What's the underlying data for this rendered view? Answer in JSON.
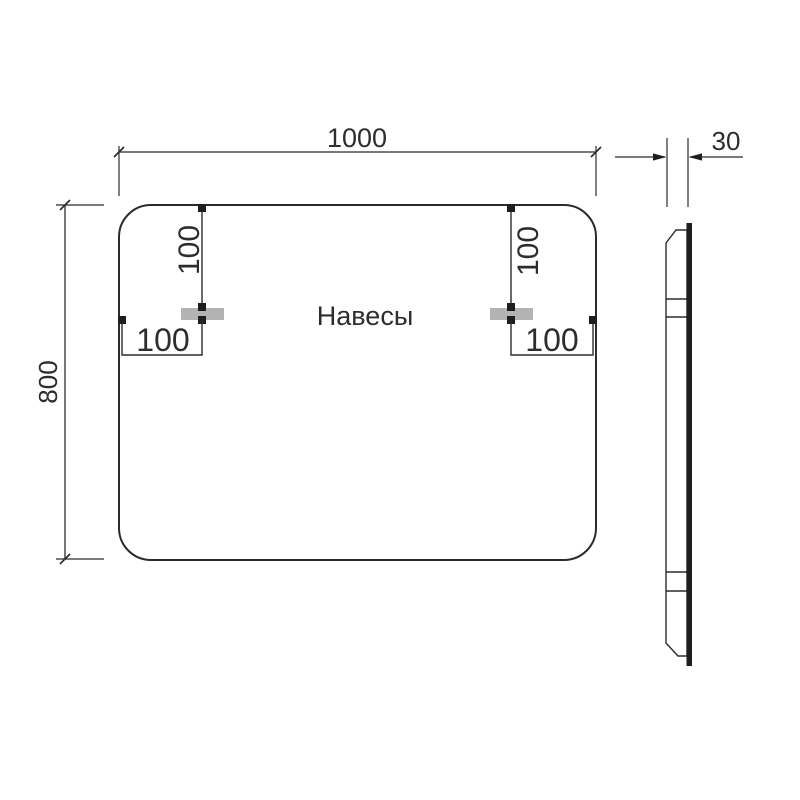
{
  "drawing": {
    "kind": "mirror-technical-dimension-drawing",
    "front_view": {
      "width_label": "1000",
      "height_label": "800",
      "center_label": "Навесы",
      "left_hanger": {
        "top_offset_label": "100",
        "side_offset_label": "100"
      },
      "right_hanger": {
        "top_offset_label": "100",
        "side_offset_label": "100"
      }
    },
    "side_view": {
      "depth_label": "30"
    },
    "colors": {
      "line": "#2b2b2b",
      "text": "#2d2d2d",
      "hanger_fill": "#b3b3b3",
      "glass_edge": "#1e1e1e",
      "background": "#ffffff"
    }
  }
}
